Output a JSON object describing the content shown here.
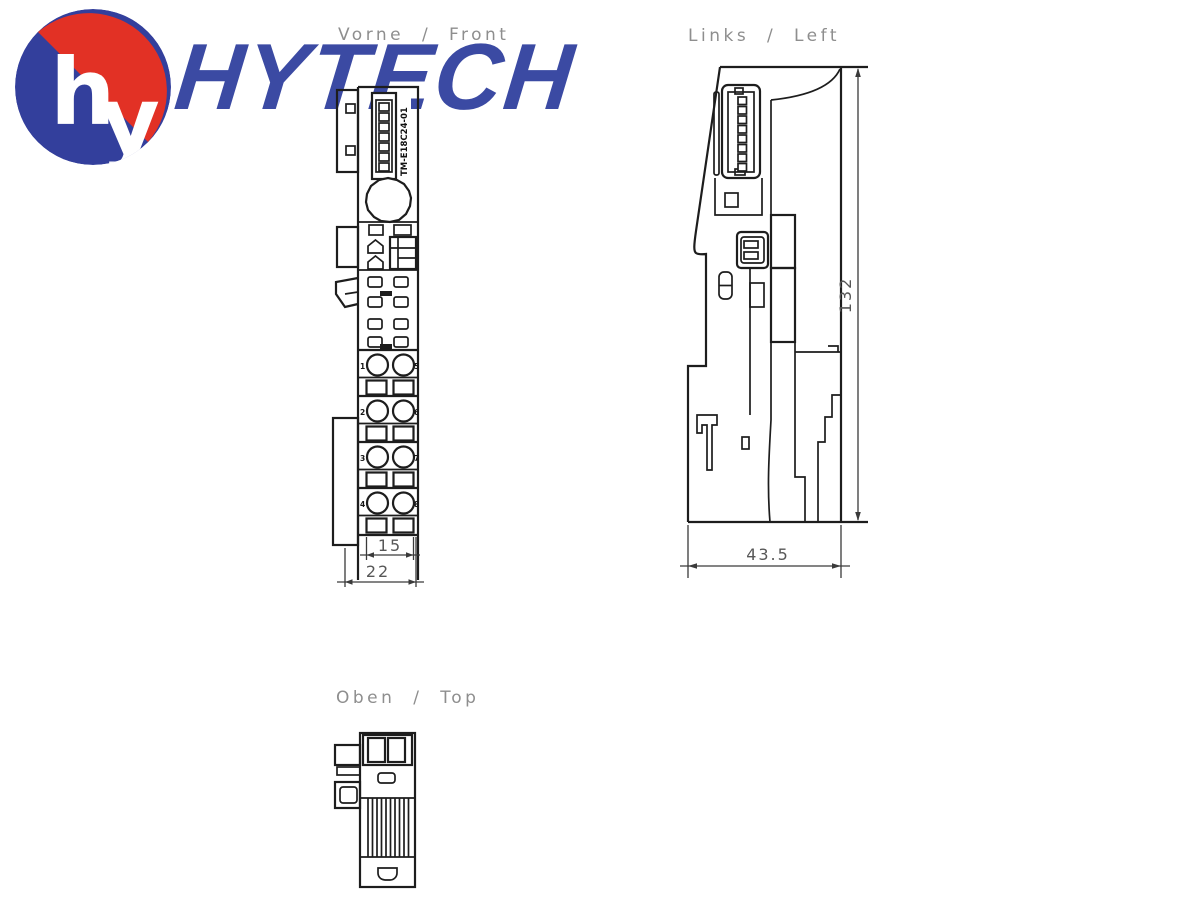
{
  "brand": {
    "monogram_h": "h",
    "monogram_y": "y",
    "wordmark": "HYTECH"
  },
  "views": {
    "front": {
      "label": "Vorne  /  Front",
      "module_code": "TM-E18C24-01",
      "terminal_numbers_left": [
        "1",
        "2",
        "3",
        "4"
      ],
      "terminal_numbers_right": [
        "5",
        "6",
        "7",
        "8"
      ],
      "dim_inner_width": "15",
      "dim_outer_width": "22"
    },
    "left": {
      "label": "Links  /  Left",
      "dim_height": "132",
      "dim_depth": "43.5"
    },
    "top": {
      "label": "Oben  /  Top"
    }
  },
  "colors": {
    "logo_red": "#e23125",
    "logo_blue": "#333f9c",
    "wordmark_blue": "#3b4aa3",
    "line_black": "#1d1d1d",
    "label_gray": "#8e8e8e",
    "dim_gray": "#575757"
  }
}
